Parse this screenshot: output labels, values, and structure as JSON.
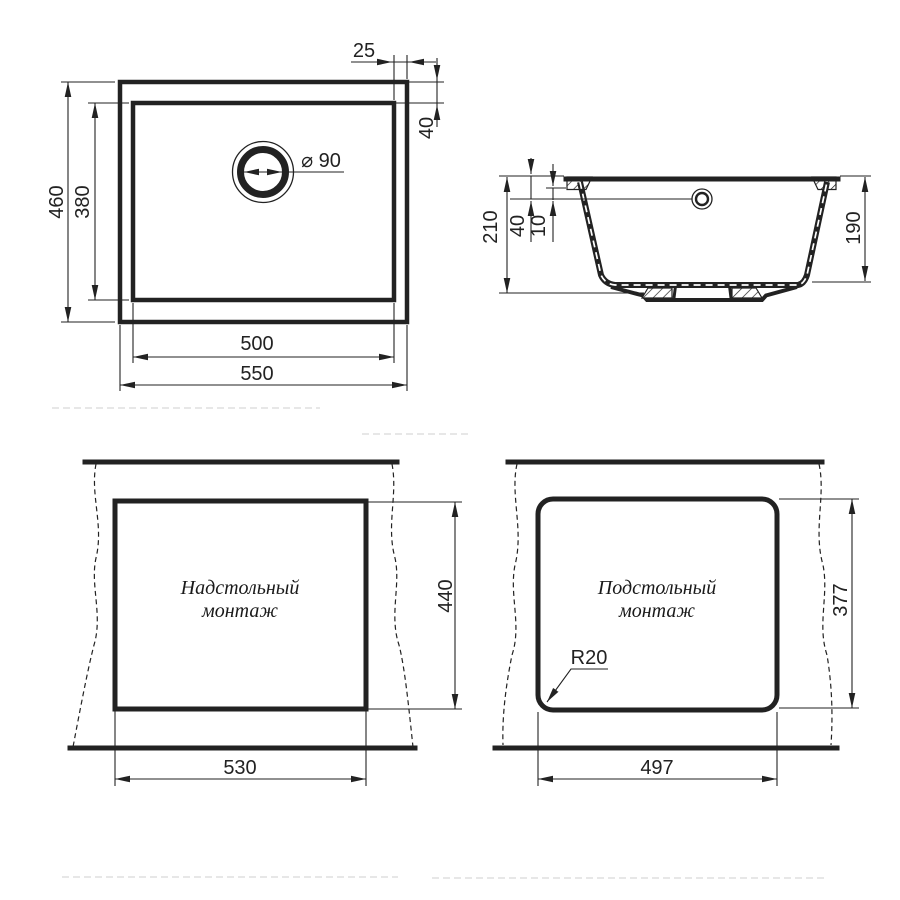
{
  "drawing": {
    "background": "#ffffff",
    "line_color": "#222222",
    "top_view": {
      "outer_width": "550",
      "inner_width": "500",
      "outer_height": "460",
      "inner_height": "380",
      "rim_side": "25",
      "rim_top": "40",
      "drain_diameter": "⌀ 90"
    },
    "section_view": {
      "total_depth": "210",
      "overflow_from_rim": "40",
      "flange_offset": "10",
      "bowl_depth": "190"
    },
    "topmount_view": {
      "label_line1": "Надстольный",
      "label_line2": "монтаж",
      "cutout_width": "530",
      "cutout_height": "440"
    },
    "undermount_view": {
      "label_line1": "Подстольный",
      "label_line2": "монтаж",
      "cutout_width": "497",
      "cutout_height": "377",
      "corner_radius": "R20"
    }
  }
}
